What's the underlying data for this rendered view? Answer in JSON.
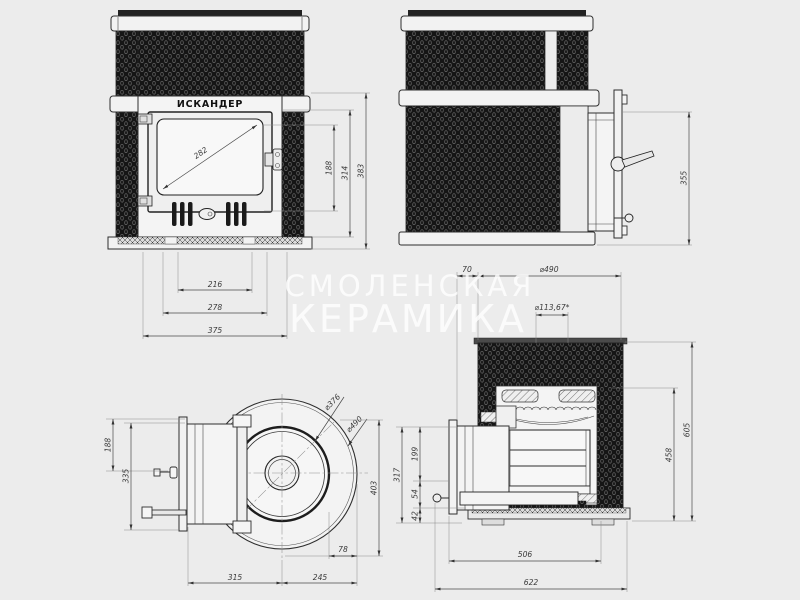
{
  "watermark": {
    "line1": "СМОЛЕНСКАЯ",
    "line2": "КЕРАМИКА"
  },
  "front_view": {
    "brand": "ИСКАНДЕР",
    "dims": {
      "glass_diagonal": "282",
      "opening_height": "188",
      "door_module_height": "314",
      "total_height": "383",
      "vent_span": "216",
      "door_panel_width": "278",
      "total_width": "375"
    }
  },
  "side_view": {
    "dims": {
      "tunnel_height": "355"
    }
  },
  "top_view": {
    "dims": {
      "tunnel_to_axis": "188",
      "flange_width": "335",
      "stone_bowl_diameter": "⌀376",
      "body_diameter": "⌀490",
      "depth": "403",
      "bowl_to_edge": "78",
      "front_to_center": "315",
      "center_to_back": "245"
    }
  },
  "section_view": {
    "dims": {
      "flange_gap": "70",
      "body_diameter": "⌀490",
      "chimney_diameter": "⌀113,67*",
      "left_total": "317",
      "firebox_height": "199",
      "mid_height": "54",
      "base_height": "42",
      "inner_height": "458",
      "total_height": "605",
      "body_depth": "506",
      "total_depth": "622"
    }
  },
  "colors": {
    "background": "#ececec",
    "line": "#2e2e2e",
    "mesh": "#151515",
    "panel": "#f2f2f2",
    "watermark": "#ffffff"
  }
}
